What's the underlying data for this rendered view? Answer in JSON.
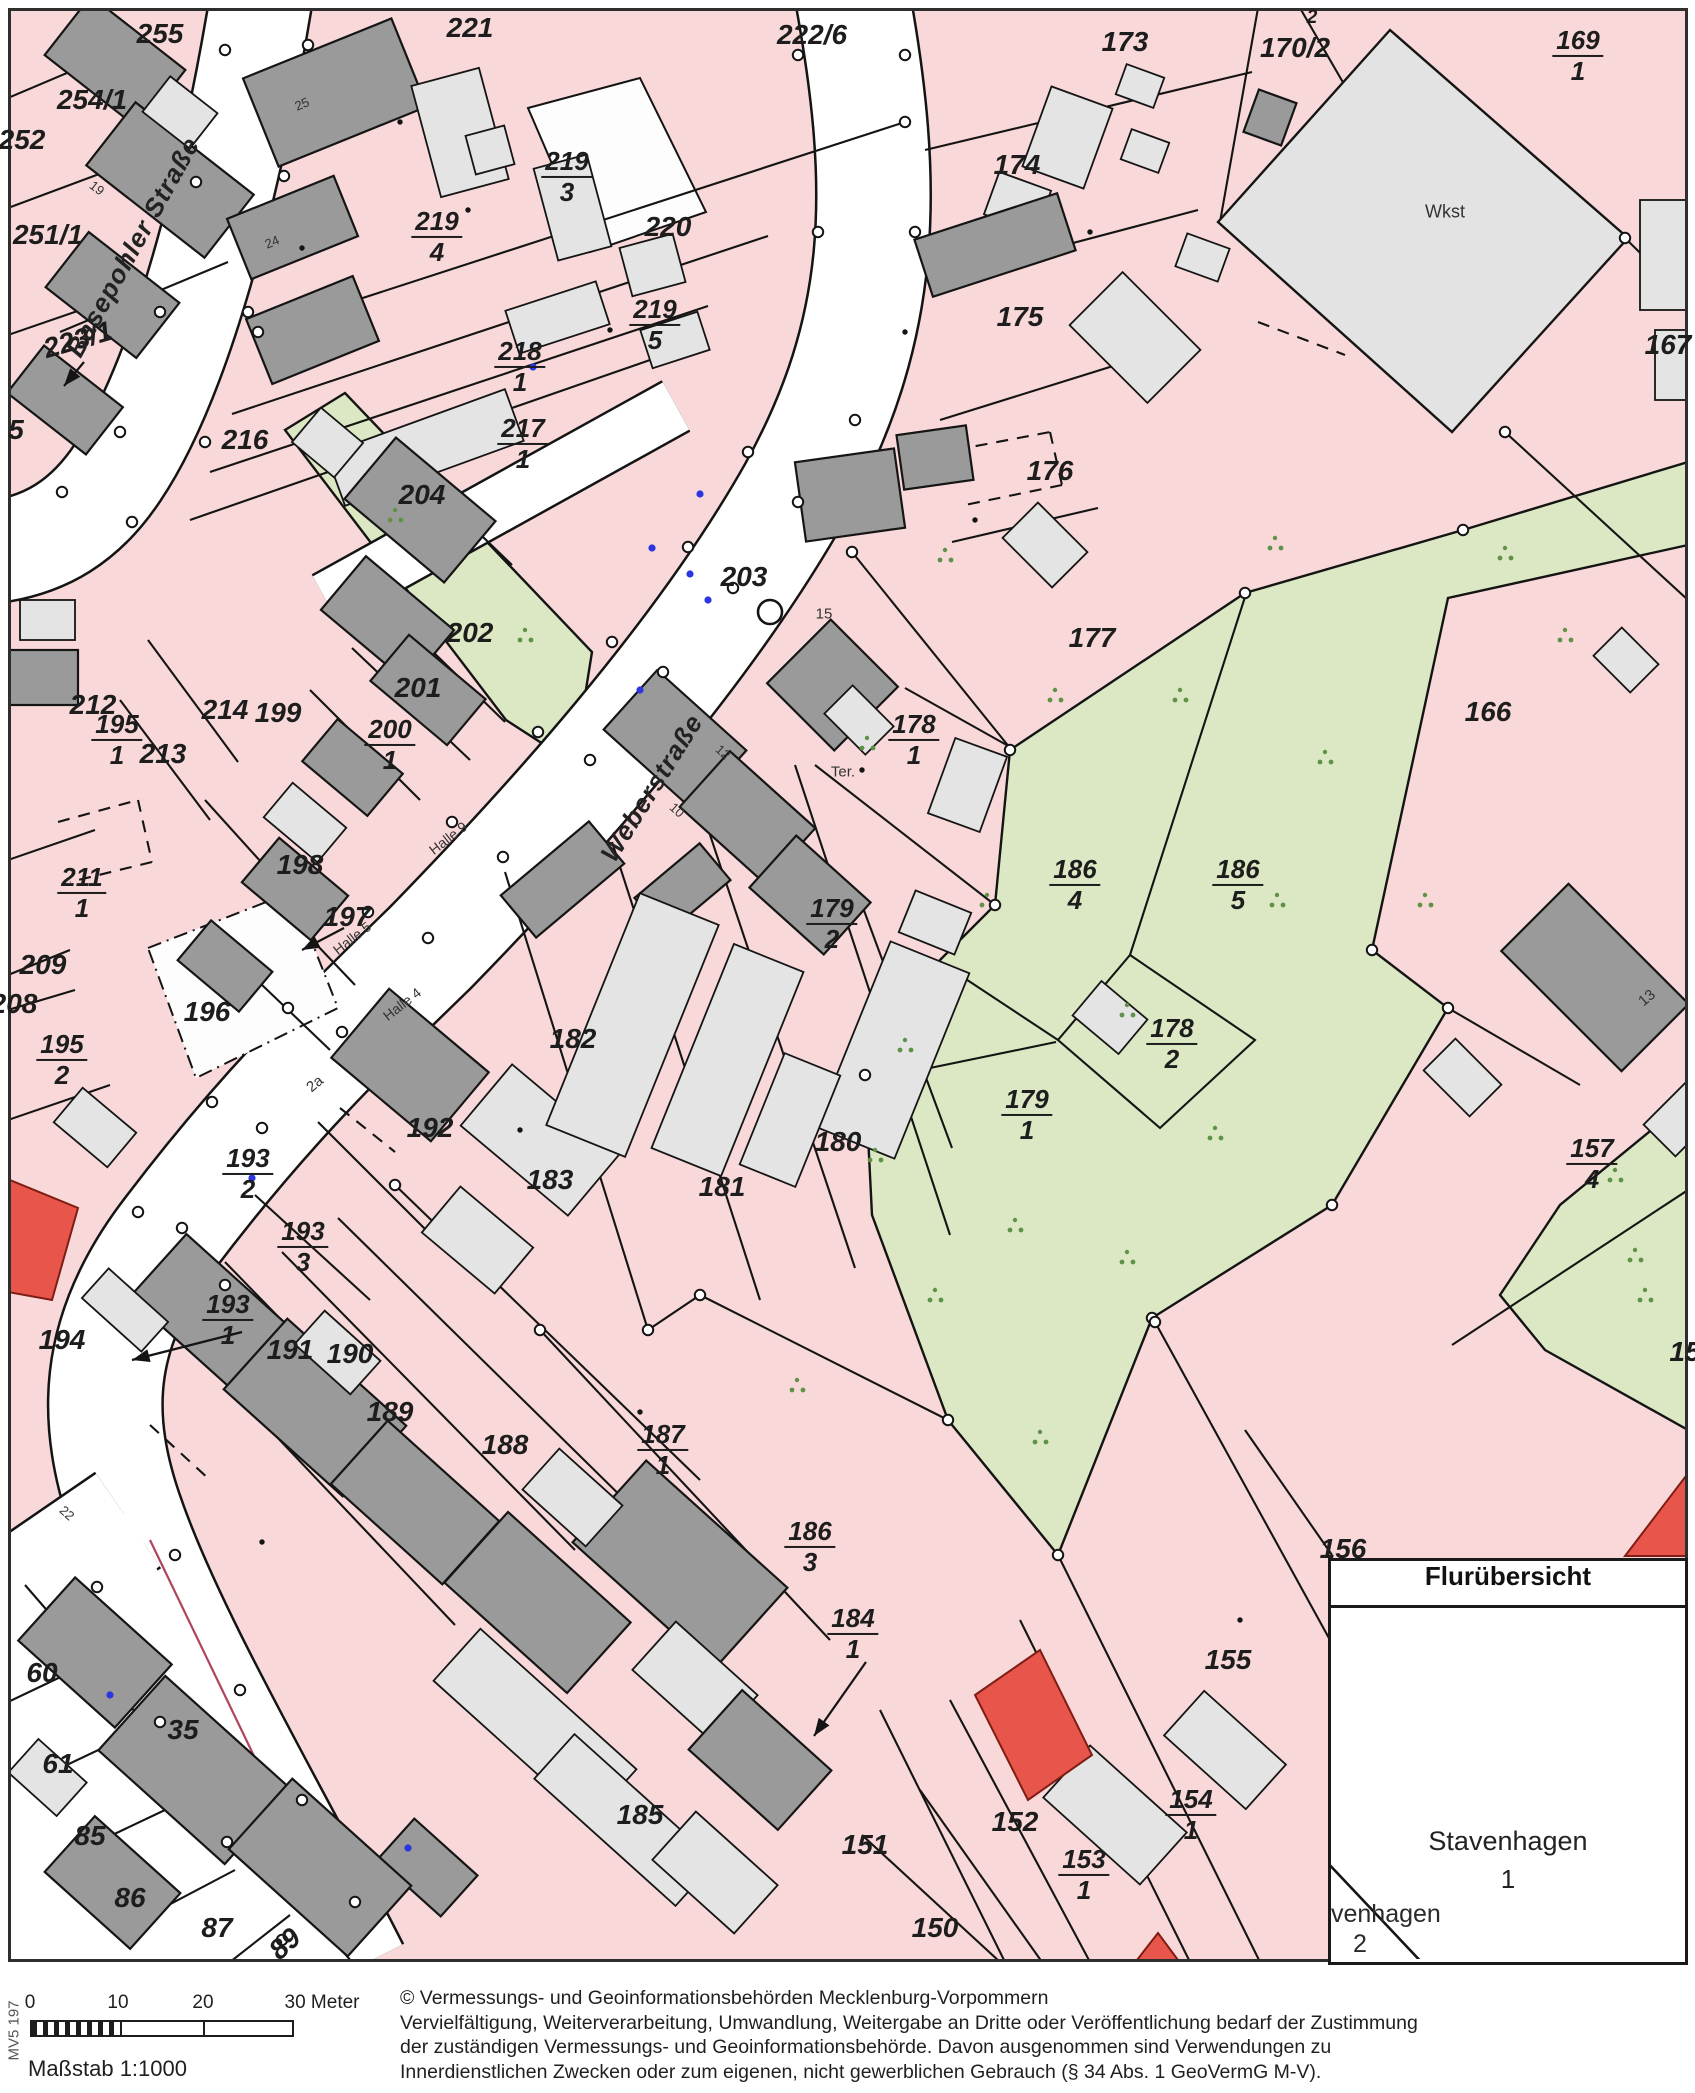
{
  "colors": {
    "parcel_pink": "#f8d8d8",
    "greenland": "#dce8c3",
    "veg_dot": "#5d9247",
    "building_dark": "#9a9a9a",
    "building_light": "#e4e4e4",
    "red_parcel": "#e8554a",
    "line": "#141414",
    "blue_point": "#2b35e0",
    "street_white": "#ffffff"
  },
  "streets": {
    "s1": "Basepohler Straße",
    "s2": "Weberstraße"
  },
  "labels": {
    "plain": [
      {
        "t": "255",
        "x": 160,
        "y": 34
      },
      {
        "t": "254/1",
        "x": 92,
        "y": 100
      },
      {
        "t": "252",
        "x": 22,
        "y": 140
      },
      {
        "t": "251/1",
        "x": 48,
        "y": 235
      },
      {
        "t": "5",
        "x": 16,
        "y": 430
      },
      {
        "t": "223/1",
        "x": 78,
        "y": 340,
        "r": -16
      },
      {
        "t": "216",
        "x": 245,
        "y": 440
      },
      {
        "t": "221",
        "x": 470,
        "y": 28
      },
      {
        "t": "222/6",
        "x": 812,
        "y": 35
      },
      {
        "t": "220",
        "x": 668,
        "y": 227
      },
      {
        "t": "204",
        "x": 422,
        "y": 495
      },
      {
        "t": "203",
        "x": 744,
        "y": 577
      },
      {
        "t": "202",
        "x": 470,
        "y": 633
      },
      {
        "t": "201",
        "x": 418,
        "y": 688
      },
      {
        "t": "199",
        "x": 278,
        "y": 713
      },
      {
        "t": "214",
        "x": 225,
        "y": 710
      },
      {
        "t": "212",
        "x": 93,
        "y": 705
      },
      {
        "t": "213",
        "x": 163,
        "y": 754
      },
      {
        "t": "198",
        "x": 300,
        "y": 865
      },
      {
        "t": "197",
        "x": 347,
        "y": 917
      },
      {
        "t": "196",
        "x": 207,
        "y": 1012
      },
      {
        "t": "209",
        "x": 43,
        "y": 965
      },
      {
        "t": "208",
        "x": 14,
        "y": 1004
      },
      {
        "t": "192",
        "x": 430,
        "y": 1128
      },
      {
        "t": "194",
        "x": 62,
        "y": 1340
      },
      {
        "t": "191",
        "x": 290,
        "y": 1350
      },
      {
        "t": "190",
        "x": 350,
        "y": 1354
      },
      {
        "t": "189",
        "x": 390,
        "y": 1412
      },
      {
        "t": "188",
        "x": 505,
        "y": 1445
      },
      {
        "t": "185",
        "x": 640,
        "y": 1815
      },
      {
        "t": "183",
        "x": 550,
        "y": 1180
      },
      {
        "t": "182",
        "x": 573,
        "y": 1039
      },
      {
        "t": "181",
        "x": 722,
        "y": 1187
      },
      {
        "t": "180",
        "x": 838,
        "y": 1142
      },
      {
        "t": "177",
        "x": 1092,
        "y": 638
      },
      {
        "t": "176",
        "x": 1050,
        "y": 471
      },
      {
        "t": "175",
        "x": 1020,
        "y": 317
      },
      {
        "t": "174",
        "x": 1017,
        "y": 165
      },
      {
        "t": "173",
        "x": 1125,
        "y": 42
      },
      {
        "t": "170/2",
        "x": 1295,
        "y": 48
      },
      {
        "t": "2",
        "x": 1312,
        "y": 18,
        "s": 19
      },
      {
        "t": "167",
        "x": 1668,
        "y": 345
      },
      {
        "t": "166",
        "x": 1488,
        "y": 712
      },
      {
        "t": "156",
        "x": 1343,
        "y": 1549
      },
      {
        "t": "155",
        "x": 1228,
        "y": 1660
      },
      {
        "t": "152",
        "x": 1015,
        "y": 1822
      },
      {
        "t": "151",
        "x": 865,
        "y": 1845
      },
      {
        "t": "150",
        "x": 935,
        "y": 1928
      },
      {
        "t": "35",
        "x": 183,
        "y": 1730
      },
      {
        "t": "60",
        "x": 42,
        "y": 1673
      },
      {
        "t": "61",
        "x": 58,
        "y": 1764
      },
      {
        "t": "85",
        "x": 90,
        "y": 1836
      },
      {
        "t": "86",
        "x": 130,
        "y": 1898
      },
      {
        "t": "87",
        "x": 217,
        "y": 1928
      },
      {
        "t": "89",
        "x": 285,
        "y": 1944,
        "r": -42
      },
      {
        "t": "15",
        "x": 1685,
        "y": 1352
      }
    ],
    "fractions": [
      {
        "n": "219",
        "d": "3",
        "x": 567,
        "y": 177
      },
      {
        "n": "219",
        "d": "4",
        "x": 437,
        "y": 237
      },
      {
        "n": "219",
        "d": "5",
        "x": 655,
        "y": 325
      },
      {
        "n": "218",
        "d": "1",
        "x": 520,
        "y": 367
      },
      {
        "n": "217",
        "d": "1",
        "x": 523,
        "y": 444
      },
      {
        "n": "169",
        "d": "1",
        "x": 1578,
        "y": 56
      },
      {
        "n": "195",
        "d": "1",
        "x": 117,
        "y": 740
      },
      {
        "n": "211",
        "d": "1",
        "x": 82,
        "y": 893
      },
      {
        "n": "200",
        "d": "1",
        "x": 390,
        "y": 745
      },
      {
        "n": "195",
        "d": "2",
        "x": 62,
        "y": 1060
      },
      {
        "n": "178",
        "d": "1",
        "x": 914,
        "y": 740
      },
      {
        "n": "179",
        "d": "2",
        "x": 832,
        "y": 924
      },
      {
        "n": "178",
        "d": "2",
        "x": 1172,
        "y": 1044
      },
      {
        "n": "179",
        "d": "1",
        "x": 1027,
        "y": 1115
      },
      {
        "n": "186",
        "d": "4",
        "x": 1075,
        "y": 885
      },
      {
        "n": "186",
        "d": "5",
        "x": 1238,
        "y": 885
      },
      {
        "n": "157",
        "d": "4",
        "x": 1592,
        "y": 1164
      },
      {
        "n": "193",
        "d": "2",
        "x": 248,
        "y": 1174
      },
      {
        "n": "193",
        "d": "3",
        "x": 303,
        "y": 1247
      },
      {
        "n": "193",
        "d": "1",
        "x": 228,
        "y": 1320
      },
      {
        "n": "187",
        "d": "1",
        "x": 663,
        "y": 1450
      },
      {
        "n": "186",
        "d": "3",
        "x": 810,
        "y": 1547
      },
      {
        "n": "184",
        "d": "1",
        "x": 853,
        "y": 1634
      },
      {
        "n": "154",
        "d": "1",
        "x": 1191,
        "y": 1815
      },
      {
        "n": "153",
        "d": "1",
        "x": 1084,
        "y": 1875
      }
    ],
    "street_names": [
      {
        "t": "Basepohler Straße",
        "x": 133,
        "y": 247,
        "r": -61
      },
      {
        "t": "Weberstraße",
        "x": 652,
        "y": 788,
        "r": -58
      }
    ],
    "small": [
      {
        "t": "Wkst",
        "x": 1445,
        "y": 212,
        "s": 18
      },
      {
        "t": "Ter.",
        "x": 843,
        "y": 772,
        "s": 15
      },
      {
        "t": "Halle 9",
        "x": 448,
        "y": 838,
        "r": -38,
        "s": 14
      },
      {
        "t": "Halle 5",
        "x": 352,
        "y": 938,
        "r": -38,
        "s": 14
      },
      {
        "t": "Halle 4",
        "x": 402,
        "y": 1004,
        "r": -38,
        "s": 14
      },
      {
        "t": "2a",
        "x": 315,
        "y": 1084,
        "r": -40,
        "s": 15
      },
      {
        "t": "13",
        "x": 1647,
        "y": 998,
        "r": -40,
        "s": 15
      },
      {
        "t": "15",
        "x": 824,
        "y": 614,
        "s": 15
      },
      {
        "t": "10",
        "x": 677,
        "y": 810,
        "r": 42,
        "s": 13
      },
      {
        "t": "12",
        "x": 723,
        "y": 752,
        "r": 42,
        "s": 13
      },
      {
        "t": "25",
        "x": 302,
        "y": 104,
        "r": -22,
        "s": 13
      },
      {
        "t": "24",
        "x": 272,
        "y": 242,
        "r": -22,
        "s": 13
      },
      {
        "t": "19",
        "x": 97,
        "y": 188,
        "r": 38,
        "s": 13
      },
      {
        "t": "22",
        "x": 67,
        "y": 1513,
        "r": 42,
        "s": 13
      }
    ]
  },
  "inset": {
    "title": "Flurübersicht",
    "place": "Stavenhagen",
    "flur": "1",
    "clipped_place": "venhagen",
    "clipped_flur": "2"
  },
  "footer": {
    "scale_ticks": [
      "0",
      "10",
      "20",
      "30 Meter"
    ],
    "scale_text": "Maßstab 1:1000",
    "margin_code": "MV5 197",
    "copyright": [
      "© Vermessungs- und Geoinformationsbehörden Mecklenburg-Vorpommern",
      "Vervielfältigung, Weiterverarbeitung, Umwandlung, Weitergabe an Dritte oder Veröffentlichung bedarf der Zustimmung",
      "der zuständigen Vermessungs- und Geoinformationsbehörde. Davon ausgenommen sind Verwendungen zu",
      "Innerdienstlichen Zwecken oder zum eigenen, nicht gewerblichen Gebrauch (§ 34 Abs. 1 GeoVermG M-V)."
    ]
  }
}
